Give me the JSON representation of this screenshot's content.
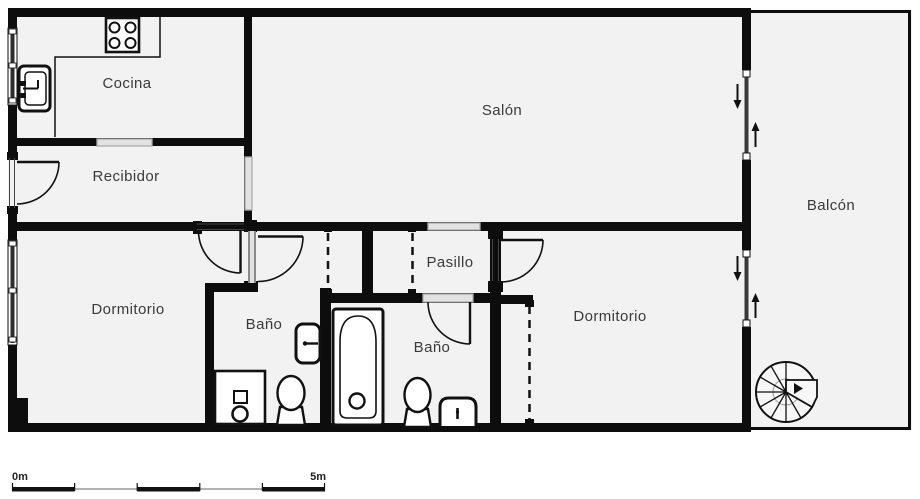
{
  "plan": {
    "type": "apartment-floor-plan",
    "colors": {
      "wall": "#0d0d0d",
      "room_fill": "#f2f2f2",
      "opening_fill": "#d6d6d6",
      "glass": "#3a3a3a",
      "label_text": "#3a3a3a"
    },
    "rooms": {
      "cocina": {
        "label": "Cocina"
      },
      "recibidor": {
        "label": "Recibidor"
      },
      "salon": {
        "label": "Salón"
      },
      "balcon": {
        "label": "Balcón"
      },
      "dormitorio1": {
        "label": "Dormitorio"
      },
      "bano1": {
        "label": "Baño"
      },
      "pasillo": {
        "label": "Pasillo"
      },
      "bano2": {
        "label": "Baño"
      },
      "dormitorio2": {
        "label": "Dormitorio"
      }
    },
    "fixtures": [
      "stove-icon",
      "kitchen-sink-icon",
      "shower-tray-icon",
      "toilet-icon",
      "wall-basin-icon",
      "bathtub-icon",
      "pedestal-basin-icon",
      "spiral-staircase-icon"
    ],
    "door_symbols": [
      "door-swing-arc",
      "sliding-door-down-arrow",
      "sliding-door-up-arrow"
    ],
    "scale_bar": {
      "start_label": "0m",
      "end_label": "5m"
    }
  }
}
